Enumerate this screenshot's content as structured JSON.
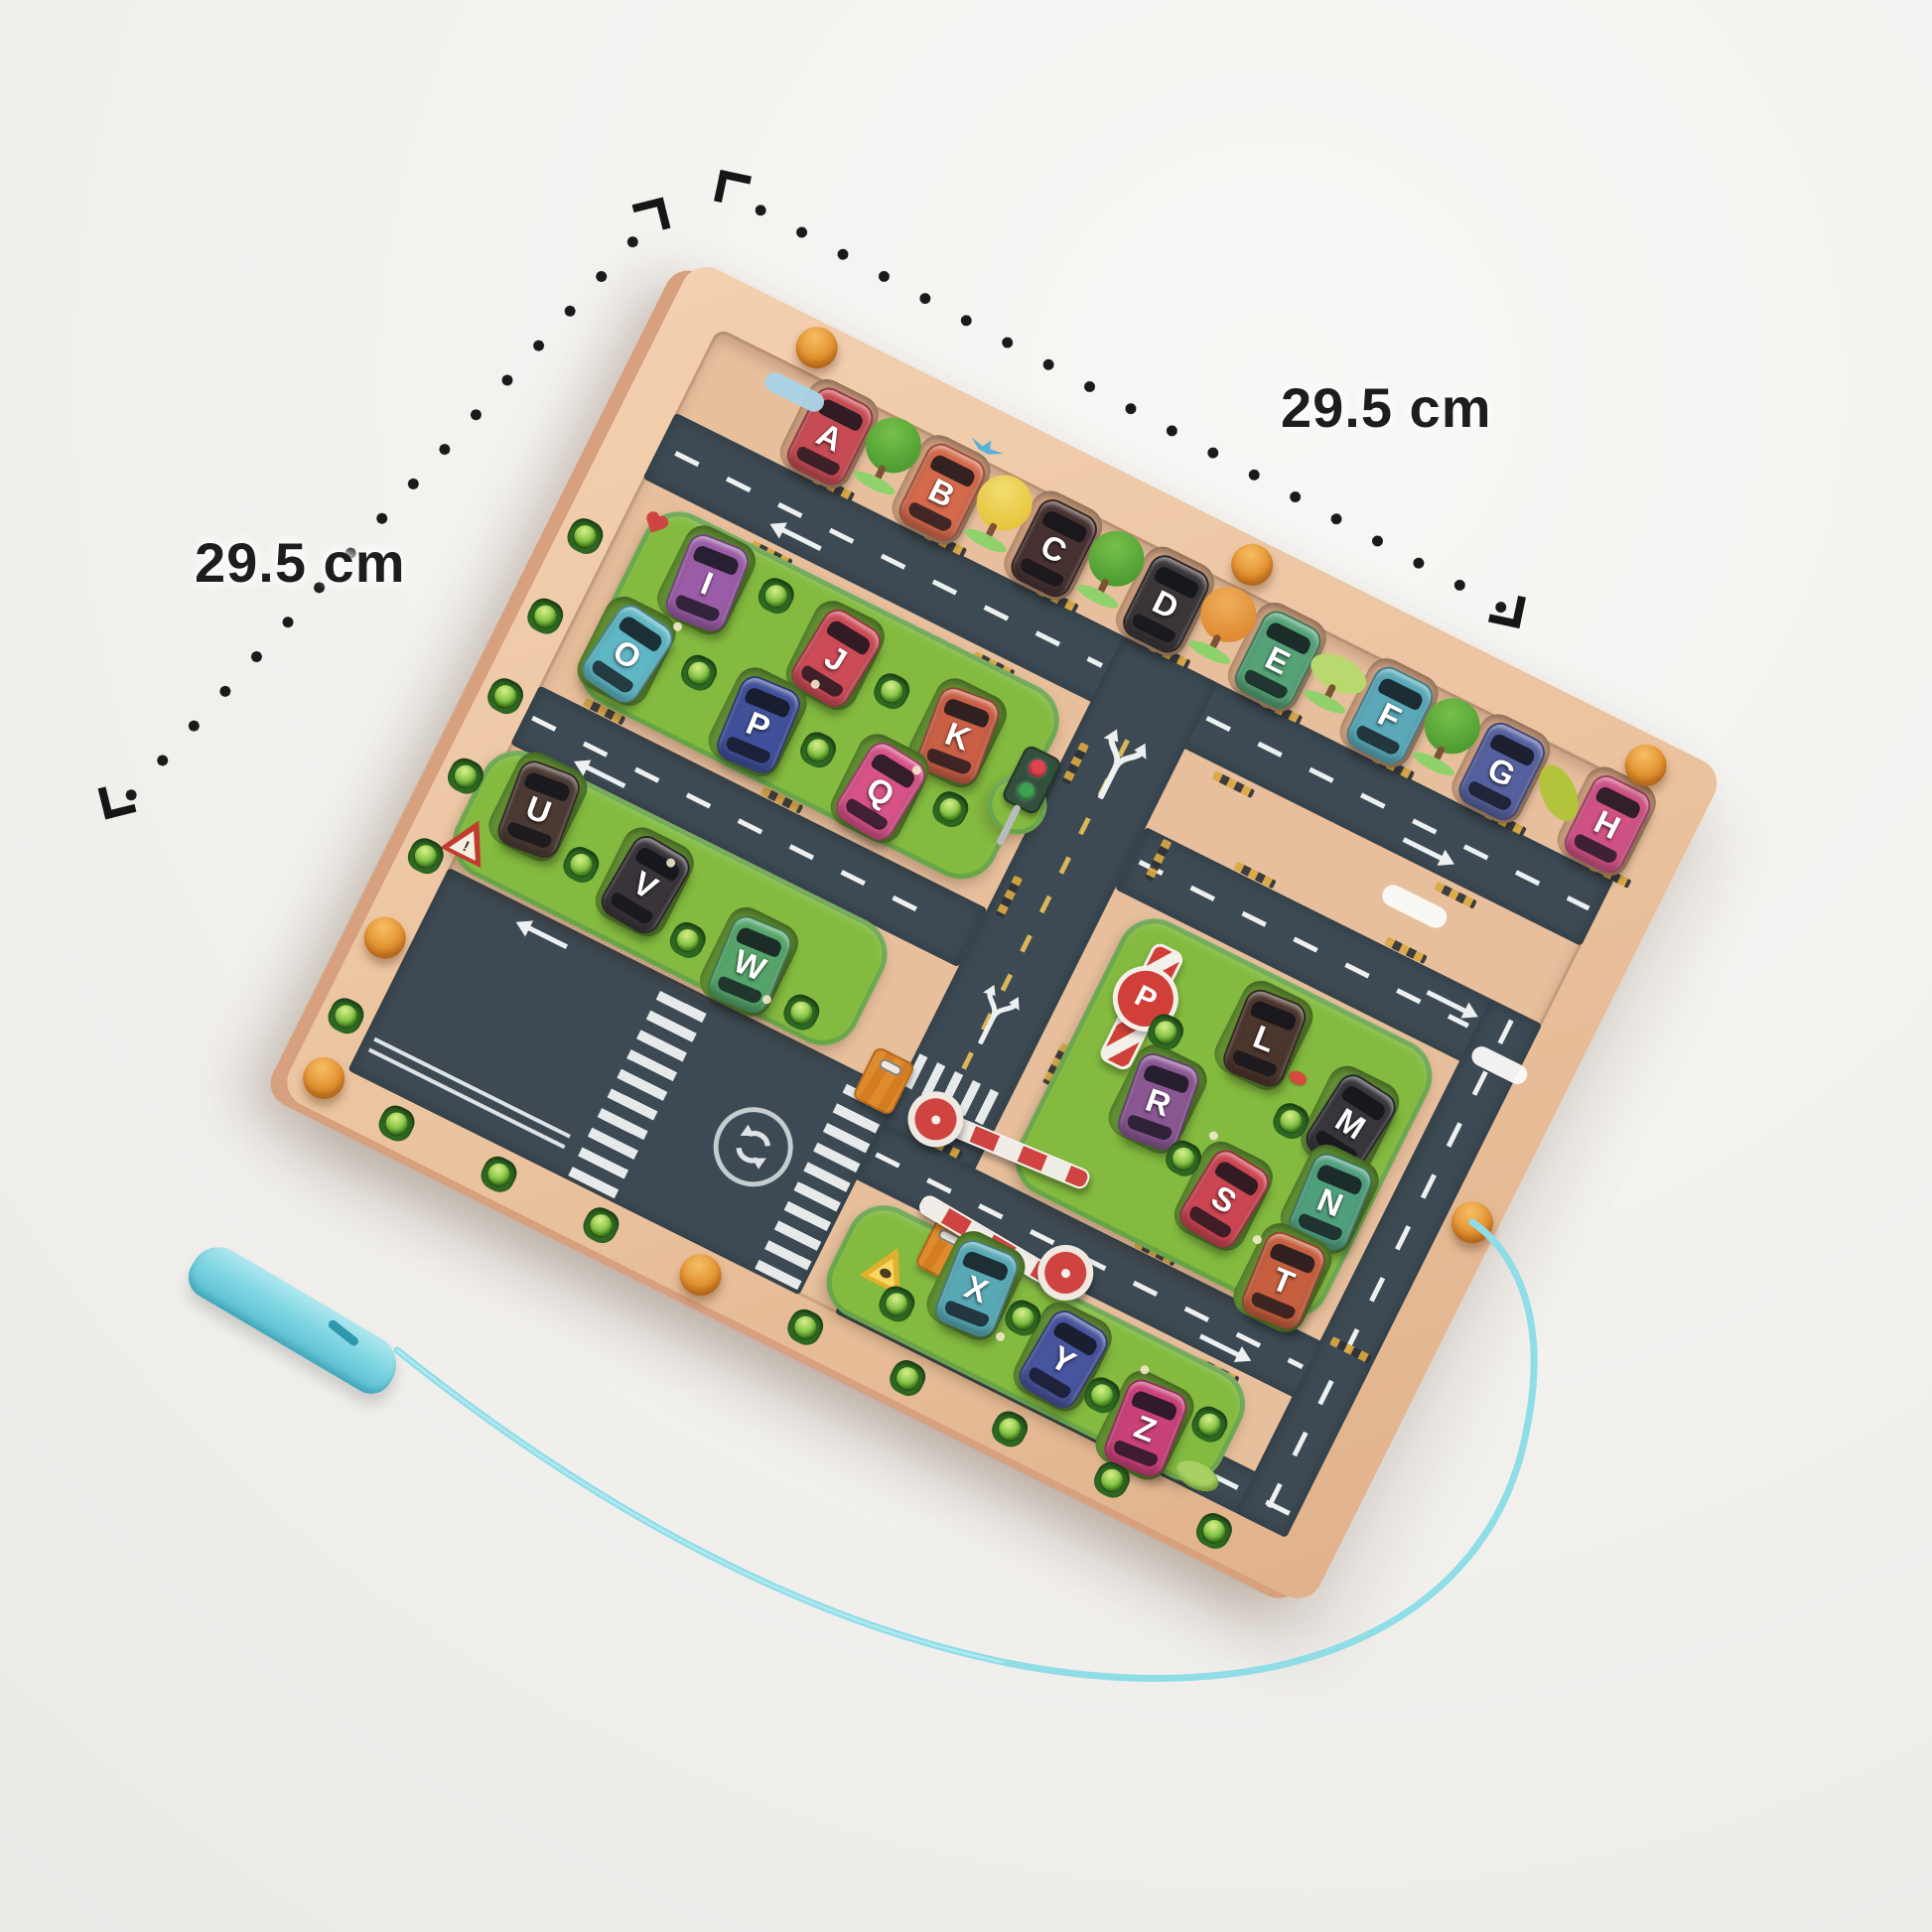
{
  "scene": {
    "background": "#f2f1ee",
    "product": "Wooden magnetic alphabet car maze board with magnetic pen"
  },
  "measurements": {
    "top": "29.5 cm",
    "left": "29.5 cm"
  },
  "palette": {
    "wood": "#eac29e",
    "wood_slot": "#d3a482",
    "road": "#3d4a53",
    "road_line": "#edf0f0",
    "center_dash_yellow": "#d9b65a",
    "grass": "#83ba3f",
    "grass_slot": "#649434",
    "peg_orange": "#e2902e",
    "bead_green": "#8cc84b",
    "pen_blue": "#7ed5e2",
    "string_blue": "#8fdde7",
    "dots_black": "#1a1a1a"
  },
  "cars": [
    {
      "letter": "A",
      "color": "#c74b54",
      "cluster": "top-row"
    },
    {
      "letter": "B",
      "color": "#d4694b",
      "cluster": "top-row"
    },
    {
      "letter": "C",
      "color": "#473231",
      "cluster": "top-row"
    },
    {
      "letter": "D",
      "color": "#3b3538",
      "cluster": "top-row"
    },
    {
      "letter": "E",
      "color": "#55a277",
      "cluster": "top-row"
    },
    {
      "letter": "F",
      "color": "#5aa8b8",
      "cluster": "top-row"
    },
    {
      "letter": "G",
      "color": "#55619f",
      "cluster": "top-row"
    },
    {
      "letter": "H",
      "color": "#d05284",
      "cluster": "top-row"
    },
    {
      "letter": "I",
      "color": "#9a5ca6",
      "cluster": "upper-left-lot"
    },
    {
      "letter": "J",
      "color": "#cc4b57",
      "cluster": "upper-left-lot"
    },
    {
      "letter": "K",
      "color": "#c95f45",
      "cluster": "upper-left-lot"
    },
    {
      "letter": "L",
      "color": "#4b362d",
      "cluster": "right-lot"
    },
    {
      "letter": "M",
      "color": "#37363b",
      "cluster": "right-lot"
    },
    {
      "letter": "N",
      "color": "#4f9f7d",
      "cluster": "right-lot"
    },
    {
      "letter": "O",
      "color": "#5fb6c4",
      "cluster": "upper-left-lot"
    },
    {
      "letter": "P",
      "color": "#40509a",
      "cluster": "upper-left-lot"
    },
    {
      "letter": "Q",
      "color": "#d65287",
      "cluster": "upper-left-lot"
    },
    {
      "letter": "R",
      "color": "#8a5793",
      "cluster": "right-lot"
    },
    {
      "letter": "S",
      "color": "#cc4553",
      "cluster": "right-lot"
    },
    {
      "letter": "T",
      "color": "#c65f3e",
      "cluster": "right-lot"
    },
    {
      "letter": "U",
      "color": "#4b3a33",
      "cluster": "lower-left-lot"
    },
    {
      "letter": "V",
      "color": "#393439",
      "cluster": "lower-left-lot"
    },
    {
      "letter": "W",
      "color": "#55a56b",
      "cluster": "lower-left-lot"
    },
    {
      "letter": "X",
      "color": "#58a9b5",
      "cluster": "bottom-lot"
    },
    {
      "letter": "Y",
      "color": "#47549e",
      "cluster": "bottom-lot"
    },
    {
      "letter": "Z",
      "color": "#c94178",
      "cluster": "bottom-lot"
    }
  ],
  "signs": {
    "parking_letter": "P",
    "warning_mark": "!",
    "traffic_light_colors": [
      "#e0434d",
      "#3da24f"
    ]
  },
  "icons": {
    "roundabout": "circular-arrows",
    "fork": "lane-split-arrows",
    "crosswalk": "zebra-stripes",
    "barrier": "boom-barrier",
    "gate": "toll-booth",
    "tree": "round-tree",
    "bird": "flying-bird",
    "cloud": "cloud",
    "heart": "heart",
    "crab": "ladybug"
  }
}
